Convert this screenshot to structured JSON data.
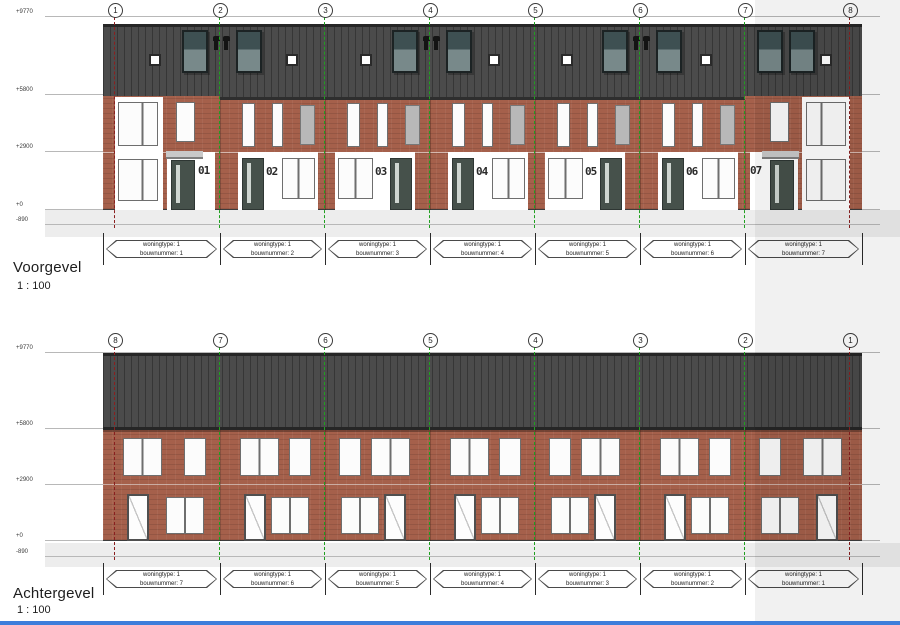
{
  "elevations": [
    {
      "title": "Voorgevel",
      "scale": "1 : 100",
      "grid_labels": [
        "1",
        "2",
        "3",
        "4",
        "5",
        "6",
        "7",
        "8"
      ],
      "levels": [
        "+9770",
        "+5800",
        "+2900",
        "+0",
        "-890"
      ],
      "houses": [
        {
          "number": "01",
          "woningtype": "1",
          "bouwnummer": "1"
        },
        {
          "number": "02",
          "woningtype": "1",
          "bouwnummer": "2"
        },
        {
          "number": "03",
          "woningtype": "1",
          "bouwnummer": "3"
        },
        {
          "number": "04",
          "woningtype": "1",
          "bouwnummer": "4"
        },
        {
          "number": "05",
          "woningtype": "1",
          "bouwnummer": "5"
        },
        {
          "number": "06",
          "woningtype": "1",
          "bouwnummer": "6"
        },
        {
          "number": "07",
          "woningtype": "1",
          "bouwnummer": "7"
        }
      ]
    },
    {
      "title": "Achtergevel",
      "scale": "1 : 100",
      "grid_labels": [
        "8",
        "7",
        "6",
        "5",
        "4",
        "3",
        "2",
        "1"
      ],
      "levels": [
        "+9770",
        "+5800",
        "+2900",
        "+0",
        "-890"
      ],
      "houses": [
        {
          "woningtype": "1",
          "bouwnummer": "7"
        },
        {
          "woningtype": "1",
          "bouwnummer": "6"
        },
        {
          "woningtype": "1",
          "bouwnummer": "5"
        },
        {
          "woningtype": "1",
          "bouwnummer": "4"
        },
        {
          "woningtype": "1",
          "bouwnummer": "3"
        },
        {
          "woningtype": "1",
          "bouwnummer": "2"
        },
        {
          "woningtype": "1",
          "bouwnummer": "1"
        }
      ]
    }
  ],
  "label_fields": {
    "woningtype": "woningtype:",
    "bouwnummer": "bouwnummer:"
  },
  "colors": {
    "brick": "#a5604b",
    "roof": "#4b4b4b",
    "door": "#46514b",
    "canopy": "#c9c9c9",
    "panel_gray": "#b8b8b8",
    "rooflight_dark": "#3e5052",
    "rooflight_light": "#78898a",
    "grid_green": "#1fa01f",
    "grid_red": "#8a1f1f",
    "ground_band": "#ededed",
    "level_line": "#b8b8b8",
    "accent_blue": "#3d7edb"
  }
}
